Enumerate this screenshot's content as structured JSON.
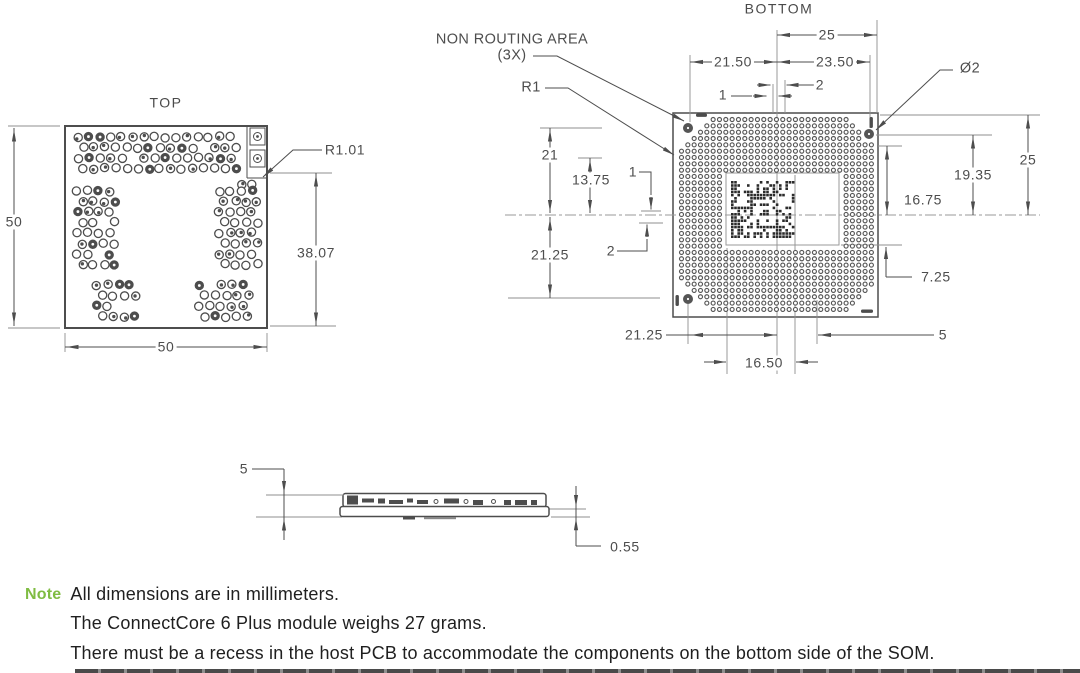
{
  "note": {
    "label": "Note",
    "color": "#7fbc42",
    "lines": [
      "All dimensions are in millimeters.",
      "The ConnectCore 6 Plus module weighs 27 grams.",
      "There must be a recess in the host PCB to accommodate the components on the bottom side of the SOM."
    ]
  },
  "views": {
    "top": {
      "title": "TOP",
      "dims": {
        "height": "50",
        "width": "50",
        "component_height": "38.07",
        "corner_radius": "R1.01"
      }
    },
    "bottom": {
      "title": "BOTTOM",
      "labels": {
        "non_routing_area": "NON ROUTING AREA",
        "qty": "(3X)",
        "radius": "R1",
        "hole_diameter": "Ø2"
      },
      "dims": {
        "top_half_width": "25",
        "top_left": "21.50",
        "top_right": "23.50",
        "top_offset_a": "1",
        "top_offset_b": "2",
        "left_upper": "21",
        "left_mid": "13.75",
        "left_offset_a": "1",
        "left_lower": "21.25",
        "left_offset_b": "2",
        "right_half": "25",
        "right_hole": "19.35",
        "right_inner": "16.75",
        "right_low": "7.25",
        "bottom_left": "21.25",
        "bottom_mid": "16.50",
        "bottom_right": "5"
      }
    },
    "side": {
      "dims": {
        "total_height": "5",
        "standoff": "0.55"
      }
    }
  }
}
